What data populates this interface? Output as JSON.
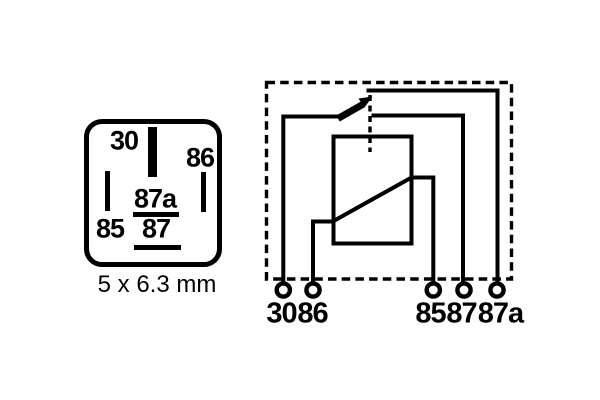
{
  "figure": {
    "pinout": {
      "pin_labels": {
        "p30": "30",
        "p86": "86",
        "p85": "85",
        "p87a": "87a",
        "p87": "87"
      },
      "caption": "5 x 6.3 mm"
    },
    "schematic": {
      "terminal_labels": {
        "t30": "30",
        "t86": "86",
        "t85": "85",
        "t87": "87",
        "t87a": "87a"
      }
    },
    "colors": {
      "ink": "#000000",
      "paper": "#ffffff"
    }
  }
}
